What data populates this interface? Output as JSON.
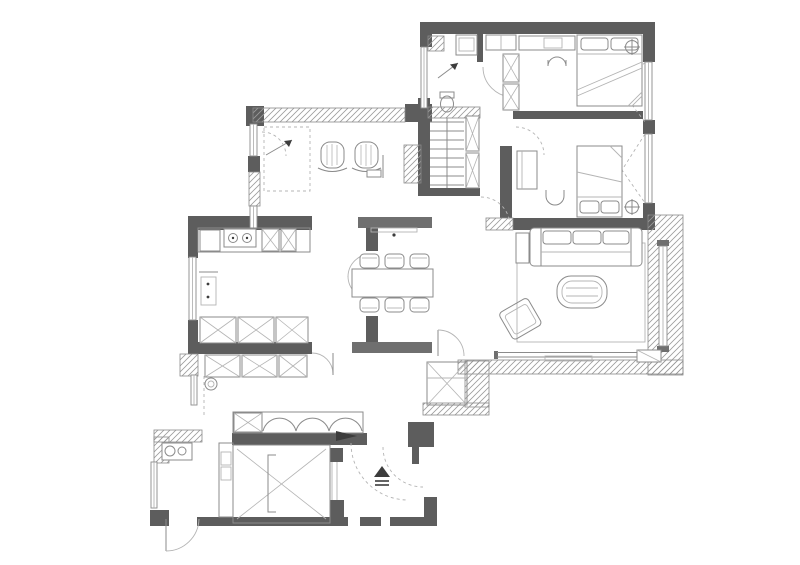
{
  "app": {
    "type": "architectural-floor-plan",
    "description": "Black and white apartment floor plan with two bedrooms, bathroom, study, kitchen, dining area, living room, balcony, entry lobby, elevator shaft and stairs"
  },
  "canvas": {
    "width": 800,
    "height": 565
  },
  "colors": {
    "background": "#ffffff",
    "wall": "#5d5d5d",
    "wall_medium": "#6f6f6f",
    "line": "#8b8b8b",
    "line_light": "#b4b4b4",
    "hatch": "#9c9c9c",
    "ink": "#3c3c3c"
  },
  "rooms": [
    {
      "name": "master-bedroom",
      "furniture": [
        "double-bed",
        "pillows",
        "wardrobe",
        "desk",
        "chair",
        "ceiling-fan"
      ]
    },
    {
      "name": "second-bedroom",
      "furniture": [
        "single-bed",
        "pillows",
        "desk",
        "chair",
        "ceiling-fan"
      ]
    },
    {
      "name": "bathroom",
      "furniture": [
        "toilet",
        "sink",
        "shower-slope-arrow"
      ]
    },
    {
      "name": "stair-core",
      "furniture": [
        "stairs",
        "tall-cabinets"
      ]
    },
    {
      "name": "study",
      "furniture": [
        "armchair",
        "armchair",
        "side-table",
        "floor-mat",
        "cabinet"
      ]
    },
    {
      "name": "kitchen",
      "furniture": [
        "cooktop-2-burner",
        "counter",
        "cabinets",
        "small-table",
        "pantry-closets"
      ]
    },
    {
      "name": "closet-corridor",
      "furniture": [
        "dressers",
        "washing-machine",
        "sliding-wardrobe"
      ]
    },
    {
      "name": "dining-area",
      "furniture": [
        "dining-table",
        "six-chairs",
        "console-sideboard"
      ]
    },
    {
      "name": "living-room",
      "furniture": [
        "sofa-3-seat",
        "coffee-table",
        "armchair",
        "rug",
        "side-table"
      ]
    },
    {
      "name": "balcony",
      "furniture": [
        "ac-unit",
        "window-band"
      ]
    },
    {
      "name": "entry-lobby",
      "furniture": [
        "entry-arrow-symbol",
        "door-swings"
      ]
    },
    {
      "name": "elevator",
      "furniture": [
        "elevator-shaft-x"
      ]
    },
    {
      "name": "utility-room",
      "furniture": [
        "laundry-counter",
        "basins",
        "door"
      ]
    },
    {
      "name": "storage-shaft",
      "furniture": [
        "x-box"
      ]
    }
  ],
  "symbols": {
    "wall_solid": "dark gray filled wall",
    "wall_hatched": "diagonal hatched exterior wall",
    "window": "double thin line",
    "door": "quarter-circle swing arc",
    "closet": "box with X",
    "entry_marker": "solid triangle above double lines"
  }
}
